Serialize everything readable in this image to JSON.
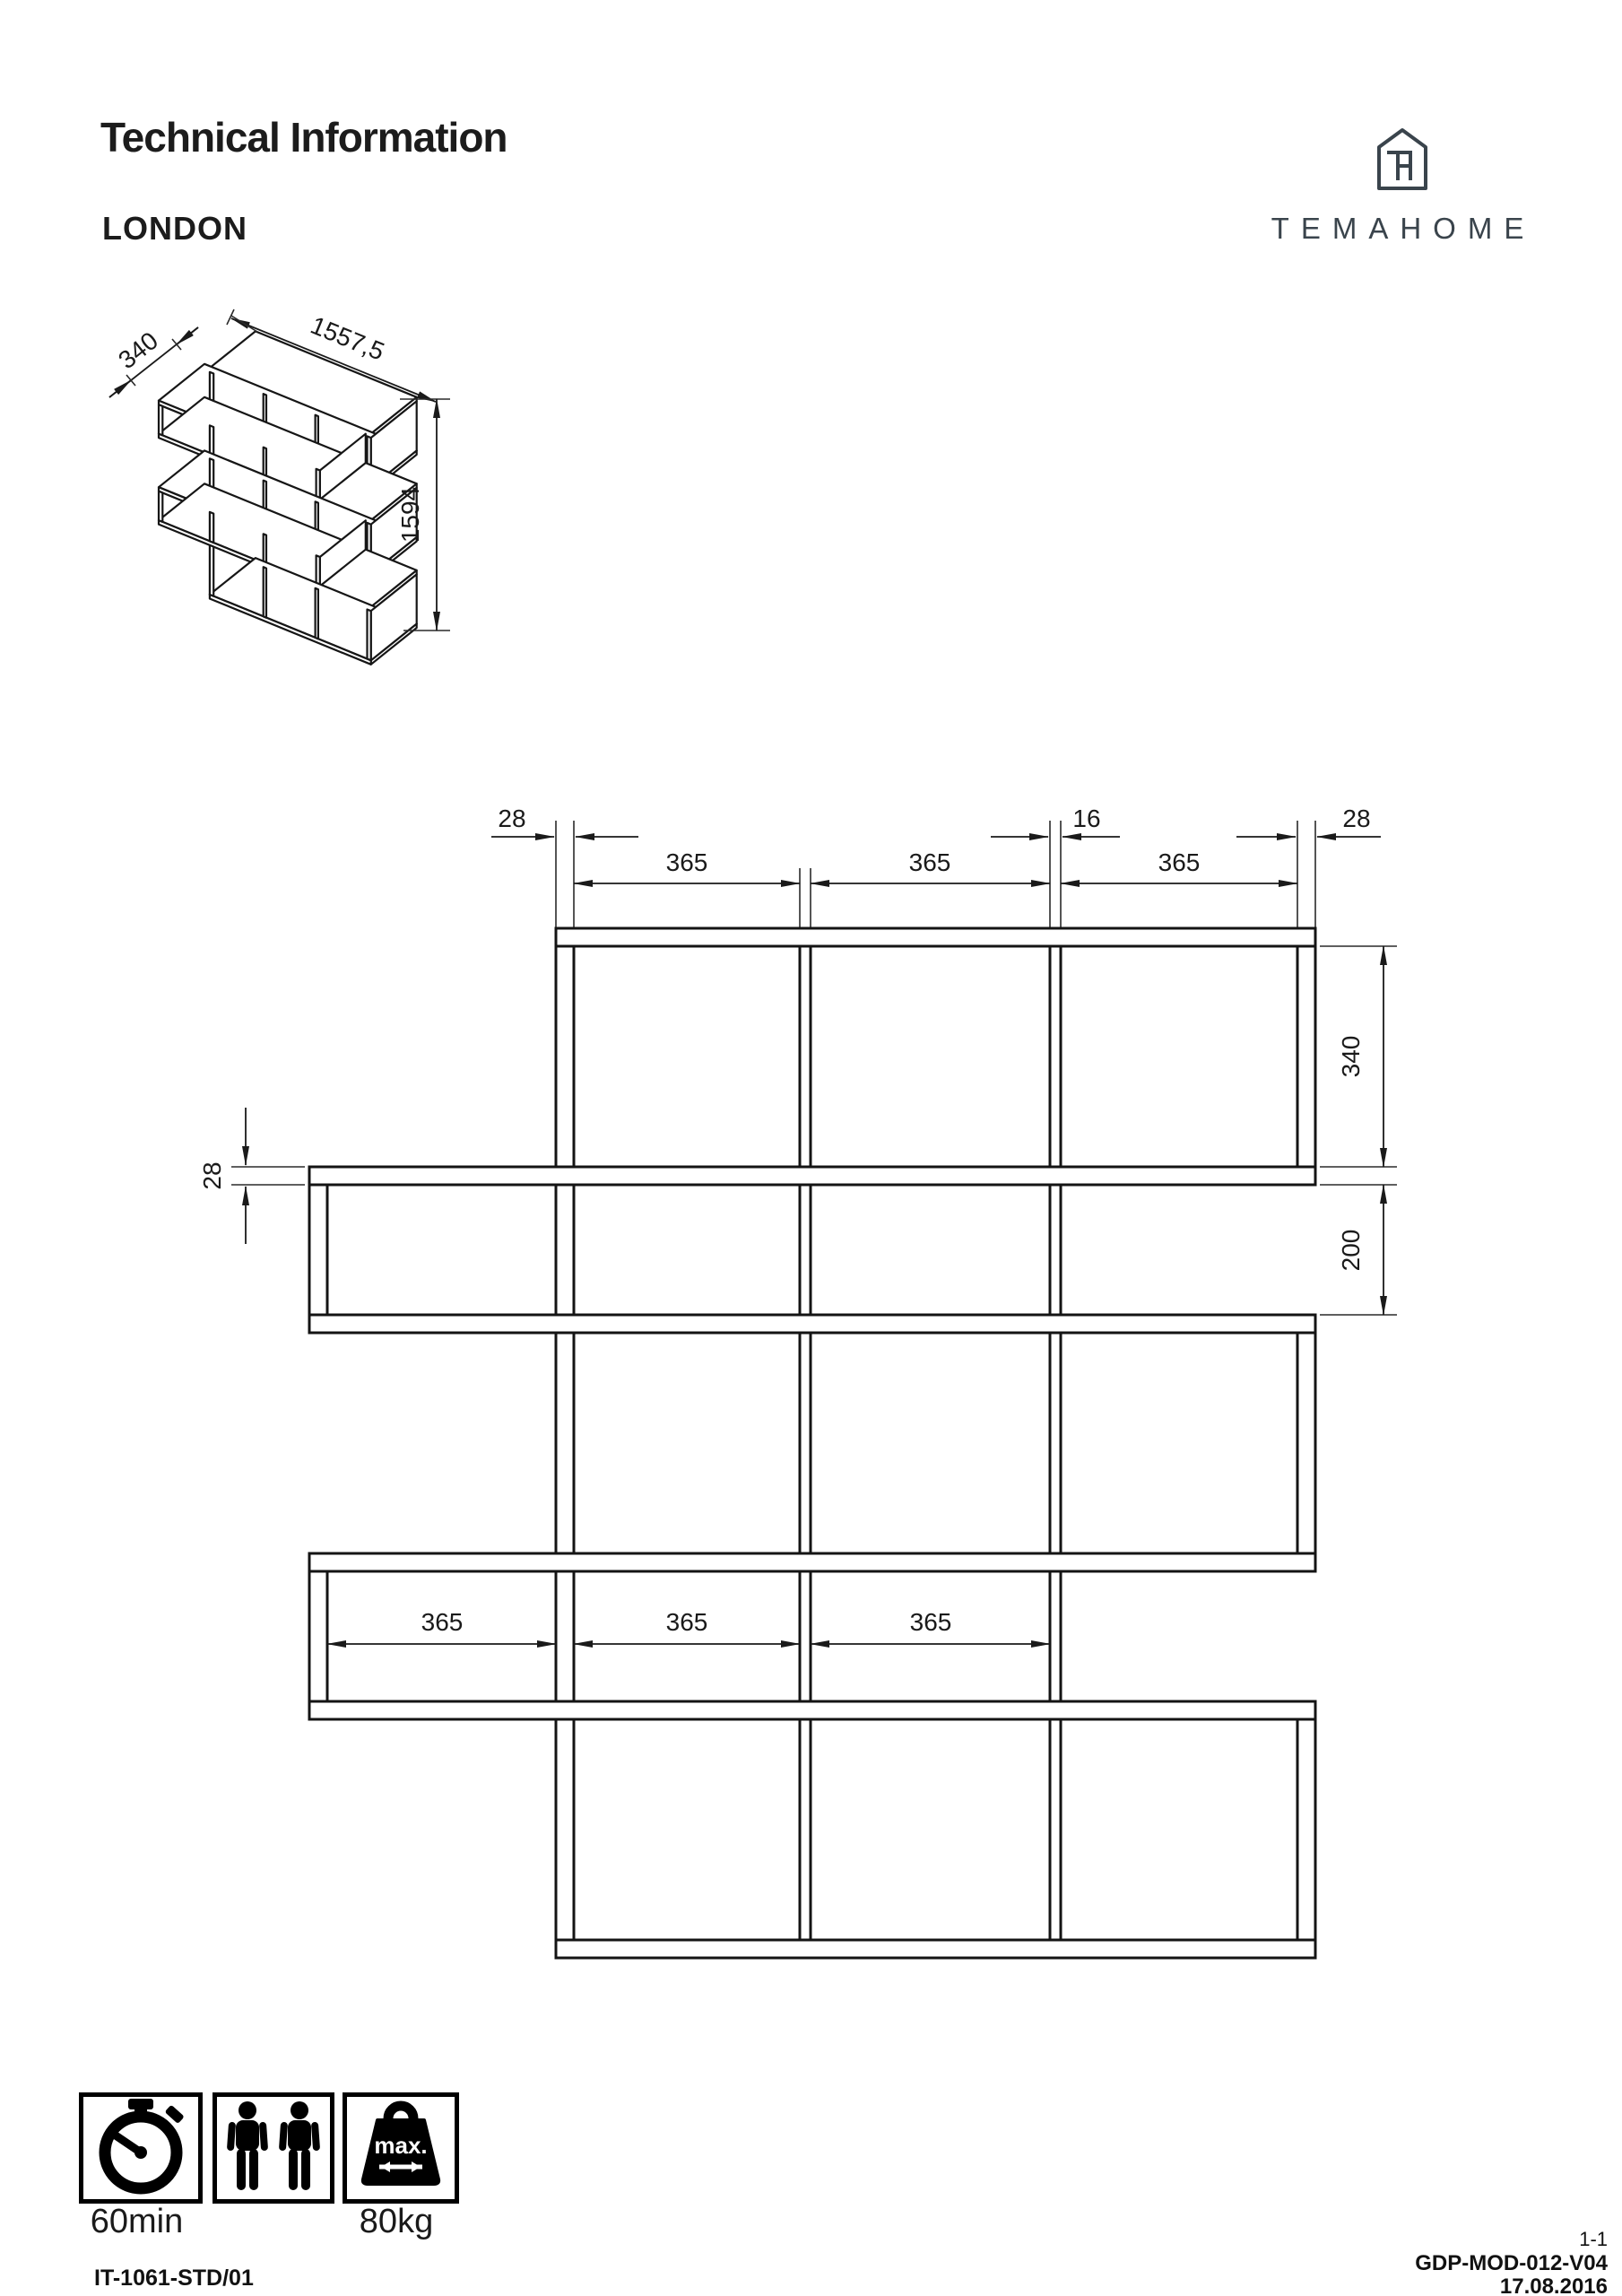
{
  "header": {
    "title": "Technical Information",
    "product": "LONDON"
  },
  "brand": {
    "name": "TEMAHOME",
    "color": "#3a444c",
    "logo_icon": "house-th-monogram-icon"
  },
  "iso_view": {
    "dims": {
      "depth": "340",
      "width": "1557,5",
      "height": "1594"
    }
  },
  "front_view": {
    "dims": {
      "end_panel_left": "28",
      "divider_gap": "16",
      "end_panel_right": "28",
      "top_cell_1": "365",
      "top_cell_2": "365",
      "top_cell_3": "365",
      "row_tall_height": "340",
      "row_short_height": "200",
      "shelf_thickness": "28",
      "row4_cell_1": "365",
      "row4_cell_2": "365",
      "row4_cell_3": "365"
    }
  },
  "footer": {
    "assembly_time": "60min",
    "max_label": "max.",
    "max_load": "80kg",
    "doc_code": "IT-1061-STD/01",
    "sheet": "1-1",
    "ref_code": "GDP-MOD-012-V04",
    "date": "17.08.2016"
  }
}
